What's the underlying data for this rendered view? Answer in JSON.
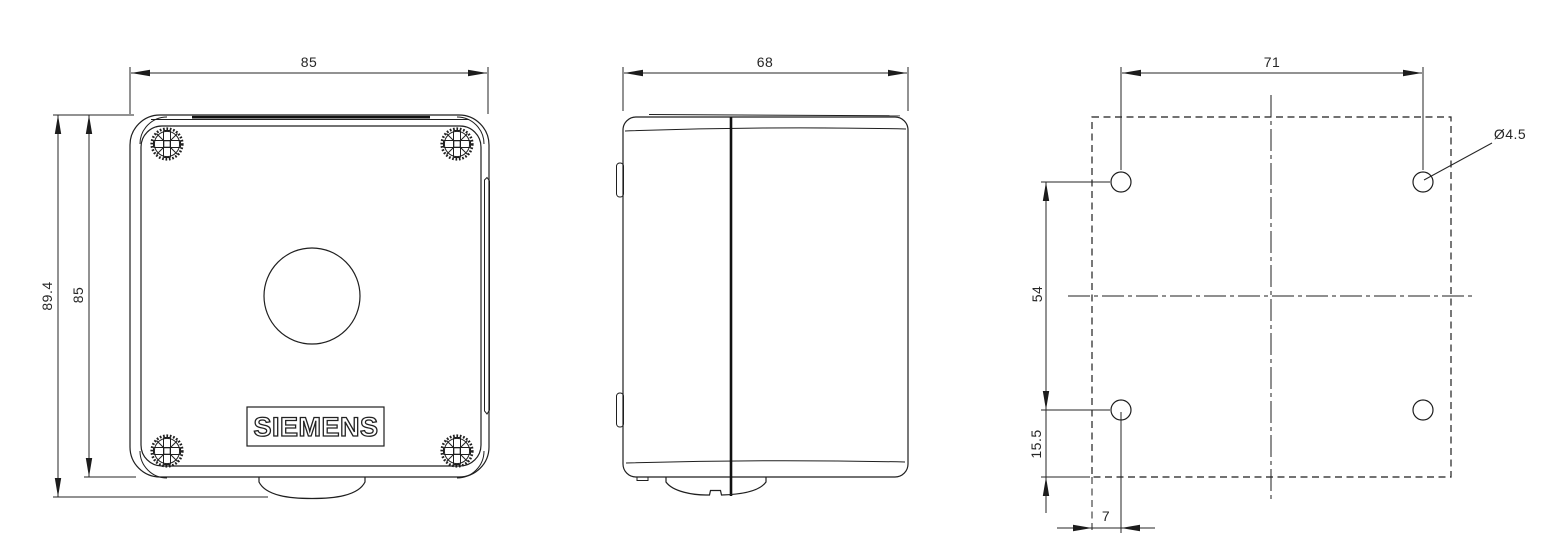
{
  "drawing_type": "dimensional technical drawing, enclosure with pushbutton hole (front, side and mounting-hole views)",
  "views": {
    "front": {
      "dim_width": "85",
      "dim_height_total": "89.4",
      "dim_height_body": "85",
      "brand": "SIEMENS"
    },
    "side": {
      "dim_depth": "68"
    },
    "mounting": {
      "dim_hole_pitch_horizontal": "71",
      "dim_hole_pitch_vertical": "54",
      "dim_hole_offset_bottom": "15.5",
      "dim_hole_offset_side": "7",
      "dim_hole_diameter": "Ø4.5"
    }
  },
  "colors": {
    "line": "#1f1f1f",
    "background": "#ffffff"
  }
}
